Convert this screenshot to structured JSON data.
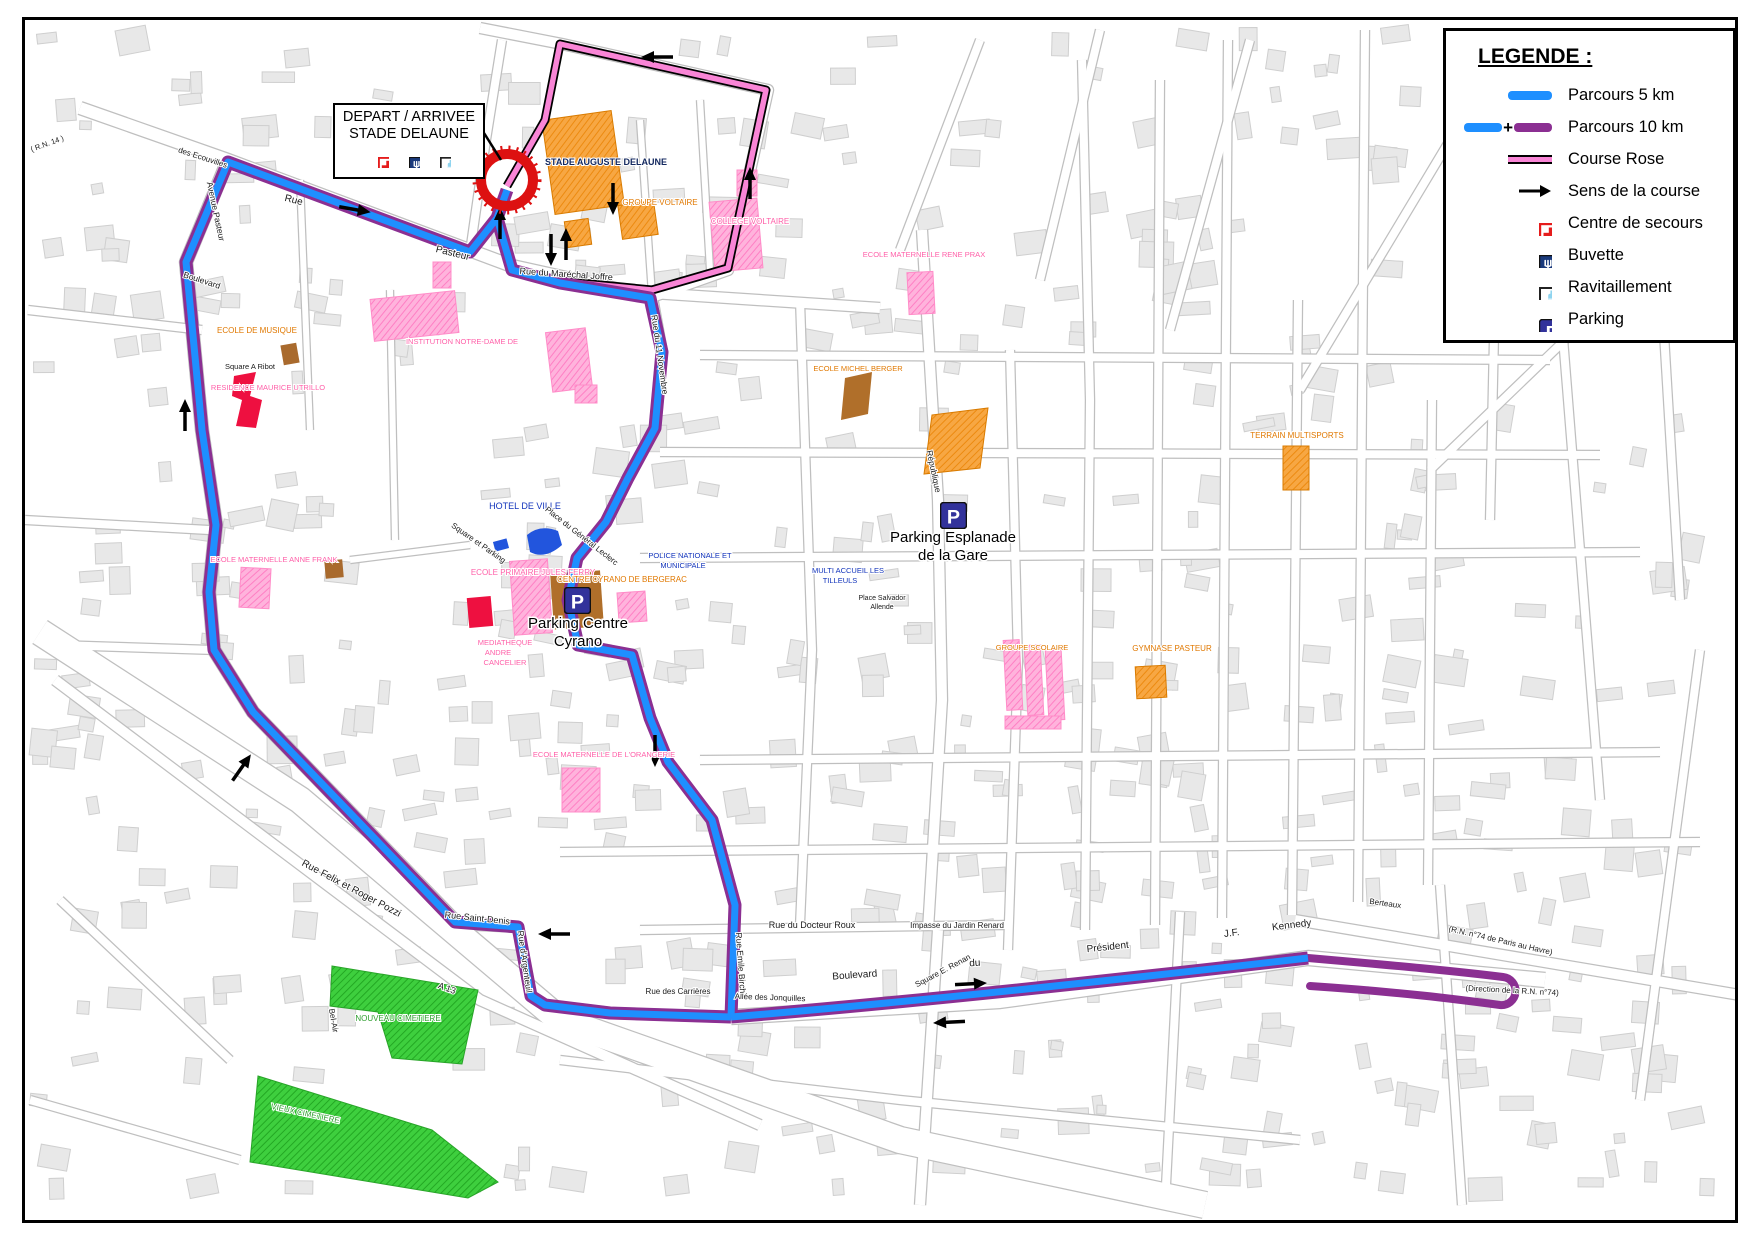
{
  "colors": {
    "route_5km_blue": "#1e8fff",
    "route_10km_purple": "#8b2f92",
    "course_rose_pink": "#f985d6",
    "secours_red": "#e51c1c",
    "buvette_navy": "#1a3a7c",
    "parking_indigo": "#32329b",
    "bottle_blue": "#8fd4ef",
    "cimetiere_green": "#33cc33",
    "building_gray": "#e8e8e8"
  },
  "legend": {
    "title": "LEGENDE :",
    "items": [
      {
        "label": "Parcours 5 km",
        "type": "line-5km"
      },
      {
        "label": "Parcours 10 km",
        "type": "line-10km"
      },
      {
        "label": "Course Rose",
        "type": "line-rose"
      },
      {
        "label": "Sens de la course",
        "type": "arrow"
      },
      {
        "label": "Centre de secours",
        "type": "icon-secours"
      },
      {
        "label": "Buvette",
        "type": "icon-buvette"
      },
      {
        "label": "Ravitaillement",
        "type": "icon-ravito"
      },
      {
        "label": "Parking",
        "type": "icon-parking"
      }
    ]
  },
  "start_box": {
    "line1": "DEPART / ARRIVEE",
    "line2": "STADE DELAUNE"
  },
  "poi": {
    "parking_letter": "P"
  },
  "map_labels": [
    {
      "t": "Rue",
      "x": 293,
      "y": 203,
      "r": 14,
      "c": "",
      "s": 10
    },
    {
      "t": "Pasteur",
      "x": 452,
      "y": 256,
      "r": 14,
      "c": "",
      "s": 10
    },
    {
      "t": "Avenue Pasteur",
      "x": 213,
      "y": 212,
      "r": 78,
      "c": "",
      "s": 8.5
    },
    {
      "t": "Boulevard",
      "x": 201,
      "y": 283,
      "r": 18,
      "c": "",
      "s": 8.5
    },
    {
      "t": "des Ecouvilles",
      "x": 202,
      "y": 160,
      "r": 18,
      "c": "",
      "s": 8
    },
    {
      "t": "( R.N. 14 )",
      "x": 48,
      "y": 146,
      "r": -20,
      "c": "",
      "s": 7.5
    },
    {
      "t": "Rue du Maréchal Joffre",
      "x": 566,
      "y": 277,
      "r": 4,
      "c": "",
      "s": 9
    },
    {
      "t": "Rue du 11 Novembre",
      "x": 657,
      "y": 355,
      "r": 82,
      "c": "",
      "s": 8.5
    },
    {
      "t": "STADE AUGUSTE DELAUNE",
      "x": 606,
      "y": 165,
      "r": 0,
      "c": "nv",
      "s": 9
    },
    {
      "t": "GROUPE VOLTAIRE",
      "x": 660,
      "y": 205,
      "r": 0,
      "c": "or",
      "s": 8
    },
    {
      "t": "COLLEGE VOLTAIRE",
      "x": 750,
      "y": 224,
      "r": 0,
      "c": "pk",
      "s": 8
    },
    {
      "t": "ECOLE DE MUSIQUE",
      "x": 257,
      "y": 333,
      "r": 0,
      "c": "or",
      "s": 8
    },
    {
      "t": "Square A Ribot",
      "x": 250,
      "y": 369,
      "r": 0,
      "c": "",
      "s": 7.5
    },
    {
      "t": "RESIDENCE MAURICE UTRILLO",
      "x": 268,
      "y": 390,
      "r": 0,
      "c": "pk",
      "s": 7.5
    },
    {
      "t": "INSTITUTION NOTRE-DAME DE",
      "x": 462,
      "y": 344,
      "r": 0,
      "c": "pk",
      "s": 7.5
    },
    {
      "t": "ECOLE MATERNELLE RENE PRAX",
      "x": 924,
      "y": 257,
      "r": 0,
      "c": "pk",
      "s": 7.5
    },
    {
      "t": "ECOLE MICHEL BERGER",
      "x": 858,
      "y": 371,
      "r": 0,
      "c": "or",
      "s": 7.5
    },
    {
      "t": "HOTEL DE VILLE",
      "x": 525,
      "y": 509,
      "r": 0,
      "c": "bl",
      "s": 9
    },
    {
      "t": "Place du Général Leclerc",
      "x": 580,
      "y": 538,
      "r": 38,
      "c": "",
      "s": 8
    },
    {
      "t": "Square et Parking",
      "x": 477,
      "y": 545,
      "r": 35,
      "c": "",
      "s": 8
    },
    {
      "t": "République",
      "x": 931,
      "y": 472,
      "r": 78,
      "c": "",
      "s": 8.5
    },
    {
      "t": "ECOLE PRIMAIRE JULES FERRY",
      "x": 533,
      "y": 575,
      "r": 0,
      "c": "pk",
      "s": 8
    },
    {
      "t": "CENTRE CYRANO DE BERGERAC",
      "x": 622,
      "y": 582,
      "r": 0,
      "c": "or",
      "s": 8
    },
    {
      "t": "POLICE NATIONALE ET",
      "x": 690,
      "y": 558,
      "r": 0,
      "c": "bl",
      "s": 7.5
    },
    {
      "t": "MUNICIPALE",
      "x": 683,
      "y": 568,
      "r": 0,
      "c": "bl",
      "s": 7.5
    },
    {
      "t": "ECOLE MATERNELLE ANNE FRANK",
      "x": 274,
      "y": 562,
      "r": 0,
      "c": "pk",
      "s": 7.5
    },
    {
      "t": "MULTI ACCUEIL LES",
      "x": 848,
      "y": 573,
      "r": 0,
      "c": "bl",
      "s": 7.5
    },
    {
      "t": "TILLEULS",
      "x": 840,
      "y": 583,
      "r": 0,
      "c": "bl",
      "s": 7.5
    },
    {
      "t": "MEDIATHEQUE",
      "x": 505,
      "y": 645,
      "r": 0,
      "c": "pk",
      "s": 7.5
    },
    {
      "t": "ANDRE",
      "x": 498,
      "y": 655,
      "r": 0,
      "c": "pk",
      "s": 7.5
    },
    {
      "t": "CANCELIER",
      "x": 505,
      "y": 665,
      "r": 0,
      "c": "pk",
      "s": 7.5
    },
    {
      "t": "Parking Esplanade",
      "x": 953,
      "y": 542,
      "r": 0,
      "c": "big",
      "s": 15
    },
    {
      "t": "de la Gare",
      "x": 953,
      "y": 560,
      "r": 0,
      "c": "big",
      "s": 15
    },
    {
      "t": "Parking Centre",
      "x": 578,
      "y": 628,
      "r": 0,
      "c": "big",
      "s": 15
    },
    {
      "t": "Cyrano",
      "x": 578,
      "y": 646,
      "r": 0,
      "c": "big",
      "s": 15
    },
    {
      "t": "Place Salvador",
      "x": 882,
      "y": 600,
      "r": 0,
      "c": "",
      "s": 7
    },
    {
      "t": "Allende",
      "x": 882,
      "y": 609,
      "r": 0,
      "c": "",
      "s": 7
    },
    {
      "t": "ECOLE MATERNELLE DE L'ORANGERIE",
      "x": 604,
      "y": 757,
      "r": 0,
      "c": "pk",
      "s": 7.5
    },
    {
      "t": "GYMNASE PASTEUR",
      "x": 1172,
      "y": 651,
      "r": 0,
      "c": "or",
      "s": 8
    },
    {
      "t": "GROUPE SCOLAIRE",
      "x": 1032,
      "y": 650,
      "r": 0,
      "c": "or",
      "s": 7.5
    },
    {
      "t": "TERRAIN MULTISPORTS",
      "x": 1297,
      "y": 438,
      "r": 0,
      "c": "or",
      "s": 8
    },
    {
      "t": "Rue Felix et Roger Pozzi",
      "x": 350,
      "y": 891,
      "r": 28,
      "c": "",
      "s": 10
    },
    {
      "t": "Rue Saint-Denis",
      "x": 477,
      "y": 921,
      "r": 6,
      "c": "",
      "s": 9
    },
    {
      "t": "Rue d'Argenteuil",
      "x": 522,
      "y": 962,
      "r": 82,
      "c": "",
      "s": 8.5
    },
    {
      "t": "Bel-Air",
      "x": 331,
      "y": 1021,
      "r": 80,
      "c": "",
      "s": 8
    },
    {
      "t": "A 13",
      "x": 446,
      "y": 991,
      "r": 20,
      "c": "",
      "s": 9
    },
    {
      "t": "NOUVEAU CIMETIERE",
      "x": 398,
      "y": 1021,
      "r": 0,
      "c": "gr",
      "s": 8
    },
    {
      "t": "VIEUX CIMETIERE",
      "x": 305,
      "y": 1116,
      "r": 12,
      "c": "gr",
      "s": 8
    },
    {
      "t": "Rue du Docteur Roux",
      "x": 812,
      "y": 928,
      "r": 0,
      "c": "",
      "s": 9
    },
    {
      "t": "Impasse du Jardin Renard",
      "x": 957,
      "y": 928,
      "r": 0,
      "c": "",
      "s": 8
    },
    {
      "t": "Square E. Renan",
      "x": 944,
      "y": 973,
      "r": -28,
      "c": "",
      "s": 8
    },
    {
      "t": "Rue des Carrières",
      "x": 678,
      "y": 994,
      "r": 0,
      "c": "",
      "s": 8
    },
    {
      "t": "Allée des Jonquilles",
      "x": 770,
      "y": 1000,
      "r": 2,
      "c": "",
      "s": 8
    },
    {
      "t": "Rue Emile Birch",
      "x": 738,
      "y": 963,
      "r": 86,
      "c": "",
      "s": 8.5
    },
    {
      "t": "Boulevard",
      "x": 855,
      "y": 978,
      "r": -4,
      "c": "",
      "s": 10
    },
    {
      "t": "du",
      "x": 975,
      "y": 966,
      "r": -4,
      "c": "",
      "s": 10
    },
    {
      "t": "Président",
      "x": 1108,
      "y": 950,
      "r": -6,
      "c": "",
      "s": 10
    },
    {
      "t": "J.F.",
      "x": 1232,
      "y": 936,
      "r": -7,
      "c": "",
      "s": 10
    },
    {
      "t": "Kennedy",
      "x": 1292,
      "y": 928,
      "r": -7,
      "c": "",
      "s": 10
    },
    {
      "t": "Berteaux",
      "x": 1385,
      "y": 906,
      "r": 8,
      "c": "",
      "s": 8
    },
    {
      "t": "(R.N. n°74 de Paris au Havre)",
      "x": 1500,
      "y": 943,
      "r": 13,
      "c": "",
      "s": 8
    },
    {
      "t": "(Direction de la R.N. n°74)",
      "x": 1512,
      "y": 993,
      "r": 3,
      "c": "",
      "s": 8
    }
  ],
  "arrows": [
    {
      "x": 660,
      "y": 57,
      "a": 180
    },
    {
      "x": 750,
      "y": 186,
      "a": -90
    },
    {
      "x": 613,
      "y": 196,
      "a": 90
    },
    {
      "x": 551,
      "y": 247,
      "a": 90
    },
    {
      "x": 566,
      "y": 247,
      "a": -90
    },
    {
      "x": 500,
      "y": 226,
      "a": -90
    },
    {
      "x": 352,
      "y": 209,
      "a": 10
    },
    {
      "x": 185,
      "y": 418,
      "a": -90
    },
    {
      "x": 240,
      "y": 770,
      "a": -55
    },
    {
      "x": 655,
      "y": 748,
      "a": 90
    },
    {
      "x": 557,
      "y": 934,
      "a": 180
    },
    {
      "x": 968,
      "y": 984,
      "a": -3
    },
    {
      "x": 952,
      "y": 1022,
      "a": 177
    }
  ]
}
